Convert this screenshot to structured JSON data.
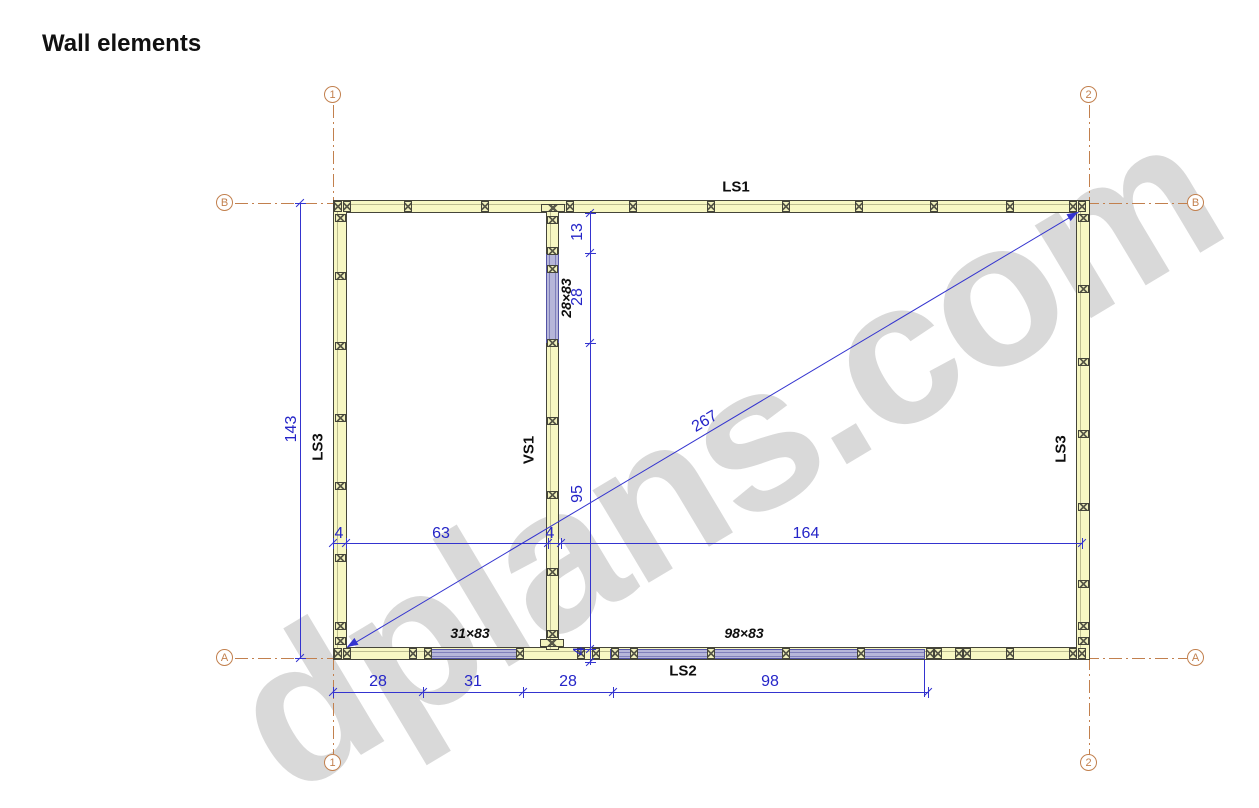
{
  "title": "Wall elements",
  "watermark_text": "dplans.com",
  "grid_markers": {
    "col_1": "1",
    "col_2": "2",
    "row_a": "A",
    "row_b": "B"
  },
  "wall_labels": {
    "top": "LS1",
    "bottom": "LS2",
    "left": "LS3",
    "right": "LS3",
    "interior": "VS1"
  },
  "element_labels": {
    "interior_opening": "28×83",
    "bottom_opening_small": "31×83",
    "bottom_opening_large": "98×83"
  },
  "dimensions": {
    "total_height": "143",
    "top_to_opening": "13",
    "opening_height": "28",
    "opening_to_bottom": "95",
    "bottom_offset": "4",
    "left_wall_thickness": "4",
    "left_bay_width": "63",
    "interior_wall_thickness": "4",
    "right_bay_width": "164",
    "diagonal": "267",
    "bottom_seg_1": "28",
    "bottom_seg_2": "31",
    "bottom_seg_3": "28",
    "bottom_seg_4": "98"
  },
  "colors": {
    "wall_fill": "#f7f7c3",
    "element_fill": "#b6b6d9",
    "dimension_blue": "#2525c8",
    "grid_orange": "#c2804e",
    "watermark_gray": "#cdcdcd"
  }
}
